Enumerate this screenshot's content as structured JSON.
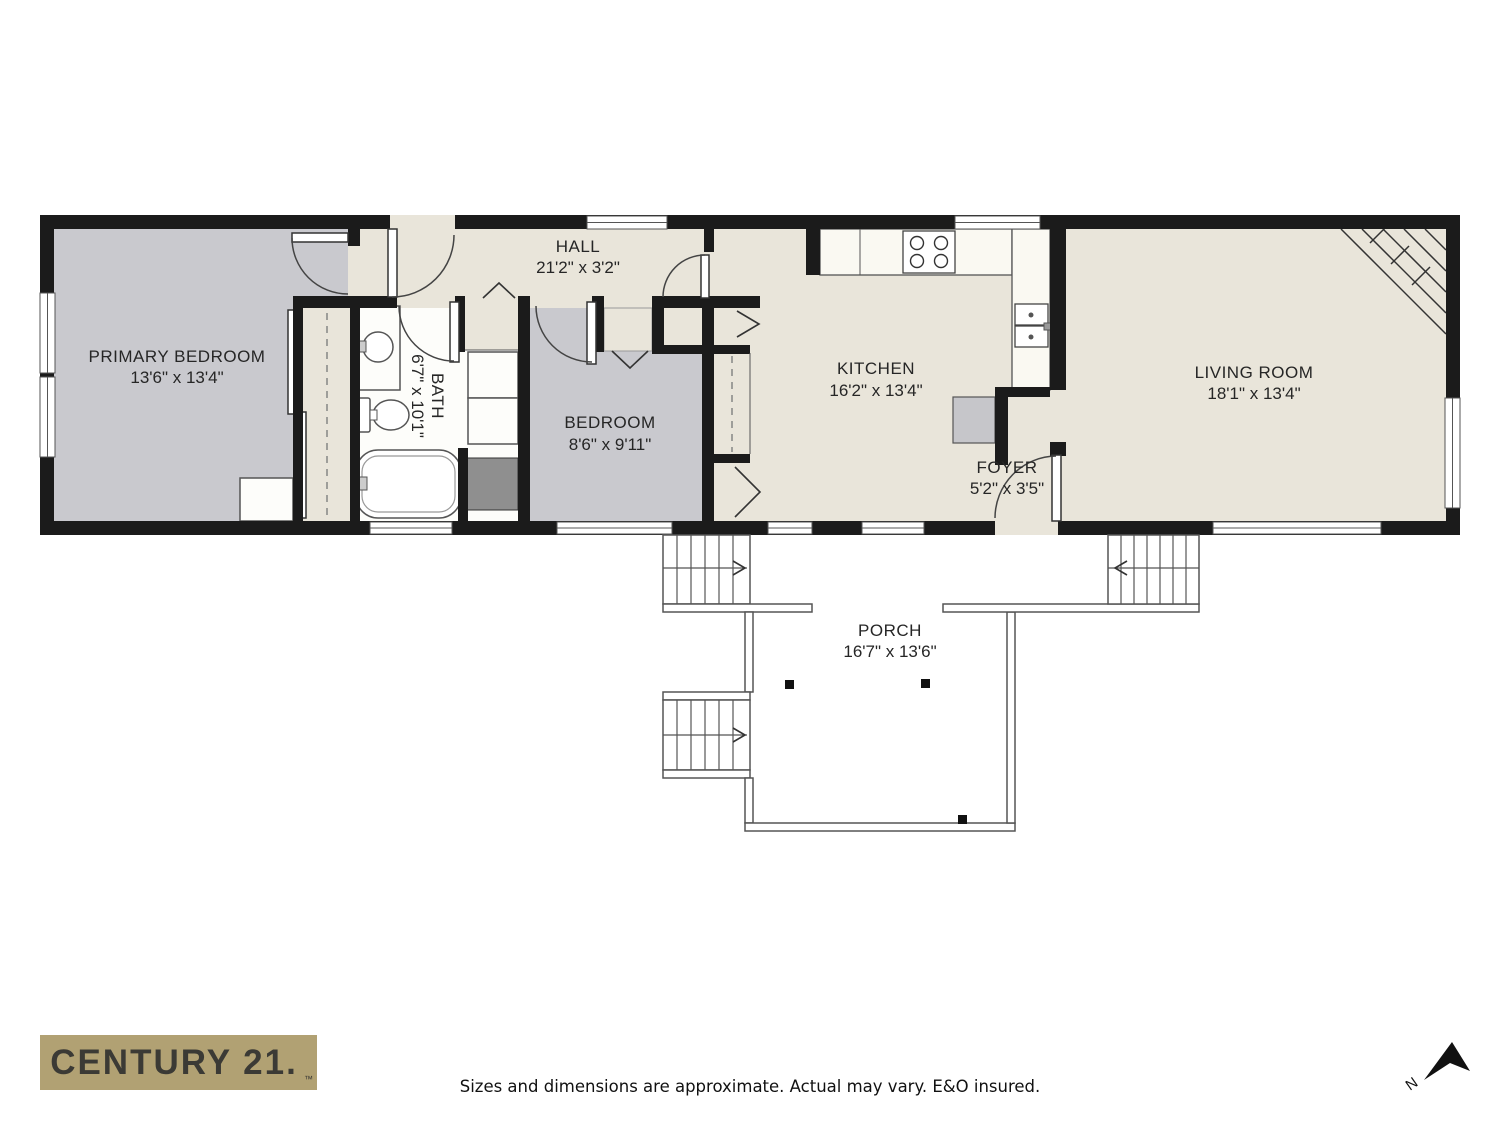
{
  "plan": {
    "rooms": {
      "primary_bedroom": {
        "name": "PRIMARY BEDROOM",
        "dims": "13'6\" x 13'4\""
      },
      "hall": {
        "name": "HALL",
        "dims": "21'2\" x 3'2\""
      },
      "bath": {
        "name": "BATH",
        "dims": "6'7\" x 10'1\""
      },
      "bedroom": {
        "name": "BEDROOM",
        "dims": "8'6\" x 9'11\""
      },
      "kitchen": {
        "name": "KITCHEN",
        "dims": "16'2\" x 13'4\""
      },
      "foyer": {
        "name": "FOYER",
        "dims": "5'2\" x 3'5\""
      },
      "living_room": {
        "name": "LIVING ROOM",
        "dims": "18'1\" x 13'4\""
      },
      "porch": {
        "name": "PORCH",
        "dims": "16'7\" x 13'6\""
      }
    },
    "compass": {
      "north_label": "N"
    }
  },
  "footer": {
    "brand": {
      "logo_text": "CENTURY 21.",
      "trademark": "™"
    },
    "disclaimer": "Sizes and dimensions are approximate. Actual may vary. E&O insured."
  },
  "colors": {
    "floor_beige": "#e9e5da",
    "room_gray": "#c9c9ce",
    "wall_black": "#1b1b1b",
    "storage_gray": "#8f8f8f",
    "logo_gold": "#b1a173",
    "logo_text": "#3b3a35"
  }
}
